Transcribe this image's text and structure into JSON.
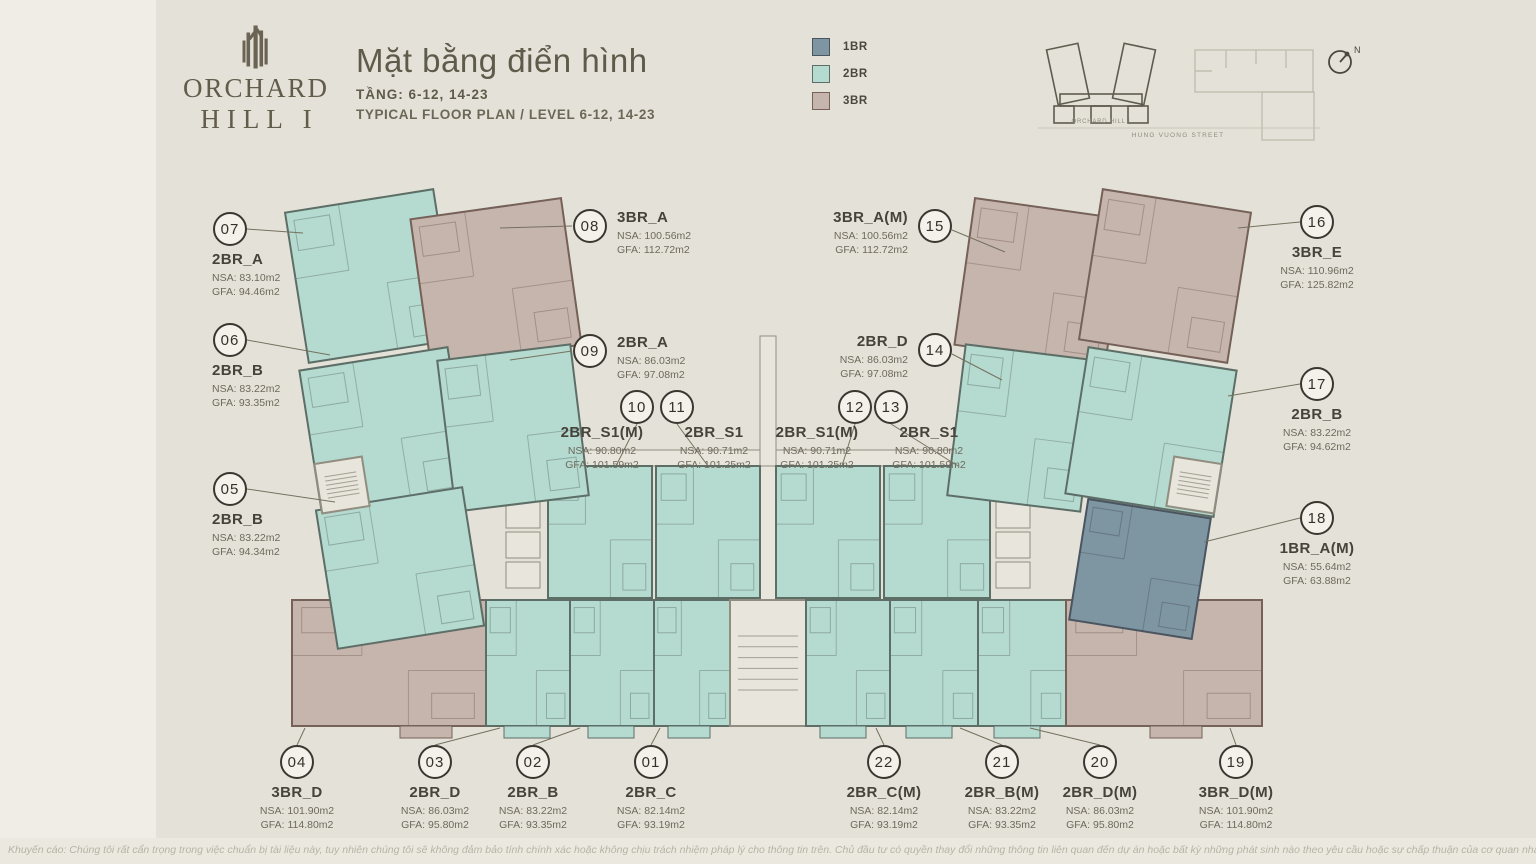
{
  "brand": {
    "name_line1": "ORCHARD",
    "name_line2": "HILL I"
  },
  "header": {
    "title": "Mặt bằng điển hình",
    "level_vi": "TẦNG: 6-12, 14-23",
    "level_en": "TYPICAL FLOOR PLAN / LEVEL 6-12, 14-23"
  },
  "legend": {
    "items": [
      {
        "label": "1BR",
        "color": "#7e95a2",
        "border": "#4a5560"
      },
      {
        "label": "2BR",
        "color": "#b5dad0",
        "border": "#5d6e67"
      },
      {
        "label": "3BR",
        "color": "#c6b5ac",
        "border": "#756158"
      }
    ]
  },
  "locator": {
    "building_label": "ORCHARD HILL I",
    "street_label": "HUNG VUONG STREET",
    "compass_label": "N"
  },
  "units": [
    {
      "number": "01",
      "name": "2BR_C",
      "nsa": "NSA: 82.14m2",
      "gfa": "GFA: 93.19m2",
      "type": "2BR"
    },
    {
      "number": "02",
      "name": "2BR_B",
      "nsa": "NSA: 83.22m2",
      "gfa": "GFA: 93.35m2",
      "type": "2BR"
    },
    {
      "number": "03",
      "name": "2BR_D",
      "nsa": "NSA: 86.03m2",
      "gfa": "GFA: 95.80m2",
      "type": "2BR"
    },
    {
      "number": "04",
      "name": "3BR_D",
      "nsa": "NSA: 101.90m2",
      "gfa": "GFA: 114.80m2",
      "type": "3BR"
    },
    {
      "number": "05",
      "name": "2BR_B",
      "nsa": "NSA: 83.22m2",
      "gfa": "GFA: 94.34m2",
      "type": "2BR"
    },
    {
      "number": "06",
      "name": "2BR_B",
      "nsa": "NSA: 83.22m2",
      "gfa": "GFA: 93.35m2",
      "type": "2BR"
    },
    {
      "number": "07",
      "name": "2BR_A",
      "nsa": "NSA: 83.10m2",
      "gfa": "GFA: 94.46m2",
      "type": "2BR"
    },
    {
      "number": "08",
      "name": "3BR_A",
      "nsa": "NSA: 100.56m2",
      "gfa": "GFA: 112.72m2",
      "type": "3BR"
    },
    {
      "number": "09",
      "name": "2BR_A",
      "nsa": "NSA: 86.03m2",
      "gfa": "GFA: 97.08m2",
      "type": "2BR"
    },
    {
      "number": "10",
      "name": "2BR_S1(M)",
      "nsa": "NSA: 90.80m2",
      "gfa": "GFA: 101.59m2",
      "type": "2BR"
    },
    {
      "number": "11",
      "name": "2BR_S1",
      "nsa": "NSA: 90.71m2",
      "gfa": "GFA: 101.25m2",
      "type": "2BR"
    },
    {
      "number": "12",
      "name": "2BR_S1(M)",
      "nsa": "NSA: 90.71m2",
      "gfa": "GFA: 101.25m2",
      "type": "2BR"
    },
    {
      "number": "13",
      "name": "2BR_S1",
      "nsa": "NSA: 90.80m2",
      "gfa": "GFA: 101.59m2",
      "type": "2BR"
    },
    {
      "number": "14",
      "name": "2BR_D",
      "nsa": "NSA: 86.03m2",
      "gfa": "GFA: 97.08m2",
      "type": "2BR"
    },
    {
      "number": "15",
      "name": "3BR_A(M)",
      "nsa": "NSA: 100.56m2",
      "gfa": "GFA: 112.72m2",
      "type": "3BR"
    },
    {
      "number": "16",
      "name": "3BR_E",
      "nsa": "NSA: 110.96m2",
      "gfa": "GFA: 125.82m2",
      "type": "3BR"
    },
    {
      "number": "17",
      "name": "2BR_B",
      "nsa": "NSA: 83.22m2",
      "gfa": "GFA: 94.62m2",
      "type": "2BR"
    },
    {
      "number": "18",
      "name": "1BR_A(M)",
      "nsa": "NSA: 55.64m2",
      "gfa": "GFA: 63.88m2",
      "type": "1BR"
    },
    {
      "number": "19",
      "name": "3BR_D(M)",
      "nsa": "NSA: 101.90m2",
      "gfa": "GFA: 114.80m2",
      "type": "3BR"
    },
    {
      "number": "20",
      "name": "2BR_D(M)",
      "nsa": "NSA: 86.03m2",
      "gfa": "GFA: 95.80m2",
      "type": "2BR"
    },
    {
      "number": "21",
      "name": "2BR_B(M)",
      "nsa": "NSA: 83.22m2",
      "gfa": "GFA: 93.35m2",
      "type": "2BR"
    },
    {
      "number": "22",
      "name": "2BR_C(M)",
      "nsa": "NSA: 82.14m2",
      "gfa": "GFA: 93.19m2",
      "type": "2BR"
    }
  ],
  "disclaimer": "Khuyến cáo: Chúng tôi rất cẩn trọng trong việc chuẩn bị tài liệu này, tuy nhiên chúng tôi sẽ không đảm bảo tính chính xác hoặc không chịu trách nhiệm pháp lý cho thông tin trên. Chủ đầu tư có quyền thay đổi những thông tin liên quan đến dự án hoặc bất kỳ những phát sinh nào theo yêu cầu hoặc sự chấp thuận của cơ quan nhà nước có thẩm quyền."
}
